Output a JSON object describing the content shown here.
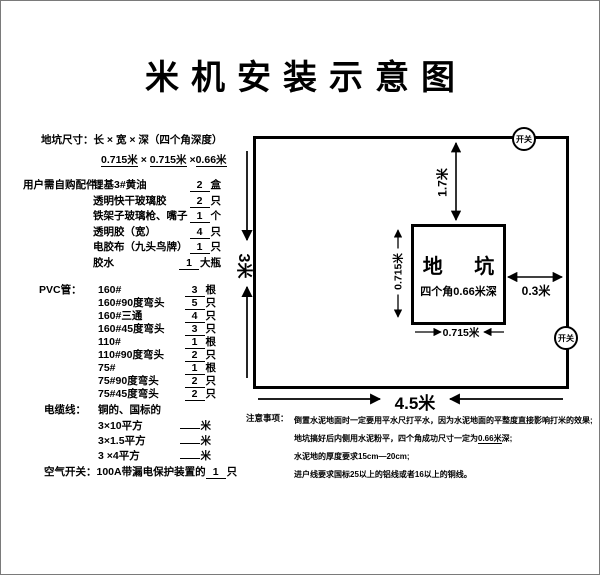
{
  "title": "米机安装示意图",
  "pit_size": {
    "label": "地坑尺寸：",
    "formula": "长 × 宽 × 深（四个角深度）",
    "v1": "0.715米",
    "x1": " × ",
    "v2": "0.715米",
    "x2": " ×",
    "v3": "0.66米"
  },
  "parts": {
    "label": "用户需自购配件：",
    "items": [
      {
        "name": "锂基3#黄油",
        "qty": "2",
        "unit": "盒"
      },
      {
        "name": "透明快干玻璃胶",
        "qty": "2",
        "unit": "只"
      },
      {
        "name": "铁架子玻璃枪、嘴子",
        "qty": "1",
        "unit": "个"
      },
      {
        "name": "透明胶（宽）",
        "qty": "4",
        "unit": "只"
      },
      {
        "name": "电胶布（九头鸟牌）",
        "qty": "1",
        "unit": "只"
      },
      {
        "name": "胶水",
        "qty": "1",
        "unit": "大瓶"
      }
    ]
  },
  "pvc": {
    "label": "PVC管：",
    "items": [
      {
        "name": "160#",
        "qty": "3",
        "unit": "根"
      },
      {
        "name": "160#90度弯头",
        "qty": "5",
        "unit": "只"
      },
      {
        "name": "160#三通",
        "qty": "4",
        "unit": "只"
      },
      {
        "name": "160#45度弯头",
        "qty": "3",
        "unit": "只"
      },
      {
        "name": "110#",
        "qty": "1",
        "unit": "根"
      },
      {
        "name": "110#90度弯头",
        "qty": "2",
        "unit": "只"
      },
      {
        "name": "75#",
        "qty": "1",
        "unit": "根"
      },
      {
        "name": "75#90度弯头",
        "qty": "2",
        "unit": "只"
      },
      {
        "name": "75#45度弯头",
        "qty": "2",
        "unit": "只"
      }
    ]
  },
  "cable": {
    "label": "电缆线：",
    "note": "铜的、国标的",
    "items": [
      {
        "name": "3×10平方",
        "qty": "",
        "unit": "米"
      },
      {
        "name": "3×1.5平方",
        "qty": "",
        "unit": "米"
      },
      {
        "name": "3 ×4平方",
        "qty": "",
        "unit": "米"
      }
    ]
  },
  "breaker": {
    "label": "空气开关：",
    "text": "100A带漏电保护装置的",
    "qty": "1",
    "unit": "只"
  },
  "diagram": {
    "switch_label": "开关",
    "pit_title": "地 坑",
    "pit_subtitle": "四个角0.66米深",
    "dim_pit_to_top": "1.7米",
    "dim_pit_to_right": "0.3米",
    "dim_pit_left": "0.715米",
    "dim_pit_bottom": "0.715米",
    "dim_room_height": "3米",
    "dim_room_width": "4.5米"
  },
  "notes": {
    "label": "注意事项：",
    "line1": "倒置水泥地面时一定要用平水尺打平水，因为水泥地面的平整度直接影响打米的效果;",
    "line2_pre": "地坑搞好后内侧用水泥粉平，四个角成功尺寸一定为",
    "line2_underlined": "0.66米",
    "line2_post": "深;",
    "line3": "水泥地的厚度要求15cm—20cm;",
    "line4": "进户线要求国标25以上的铝线或者16以上的铜线。"
  },
  "colors": {
    "ink": "#000000",
    "frame": "#7a7a7a",
    "paper": "#ffffff"
  }
}
